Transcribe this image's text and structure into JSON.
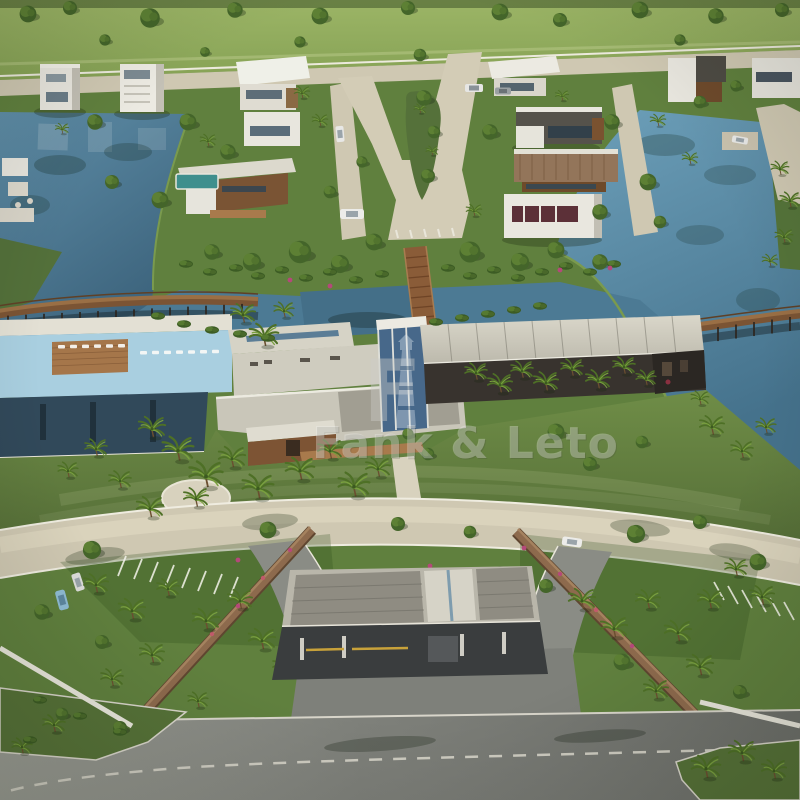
{
  "meta": {
    "subject": "Aerial 3D architectural rendering of a gated lakeside residential community: modern villas on lagoon islands, central clubhouse with pool deck, wooden boardwalk bridges, landscaped entrance gardens and gatehouse"
  },
  "watermark": {
    "logo_letter": "F",
    "text": "Fank & Leto"
  },
  "palette": {
    "water": "#54829c",
    "water_deep": "#3a5f76",
    "grass": "#5d7c3c",
    "grass_dark": "#46612a",
    "field": "#93ad5f",
    "foliage_dark": "#3f6227",
    "road_beige": "#cfc8b2",
    "asphalt": "#82847e",
    "roof_light": "#cdcabd",
    "roof_panel": "#8f8c82",
    "wood": "#8a5c38",
    "pool_deck": "#a9cfe0",
    "reflecting_pool": "#31495a",
    "stone_wall": "#8d6a4d",
    "wall_white": "#eceae2"
  },
  "scene_features": [
    "lagoon lakes",
    "residential islands with modern villas",
    "central avenue with landscaped median",
    "wooden boardwalk bridges",
    "clubhouse with flat roofs and glass tower",
    "pool deck with loungers",
    "reflecting pool",
    "crescent entrance road",
    "stone entrance walls",
    "entrance gatehouse canopy",
    "parking bays with cars",
    "palm trees",
    "entry road"
  ]
}
